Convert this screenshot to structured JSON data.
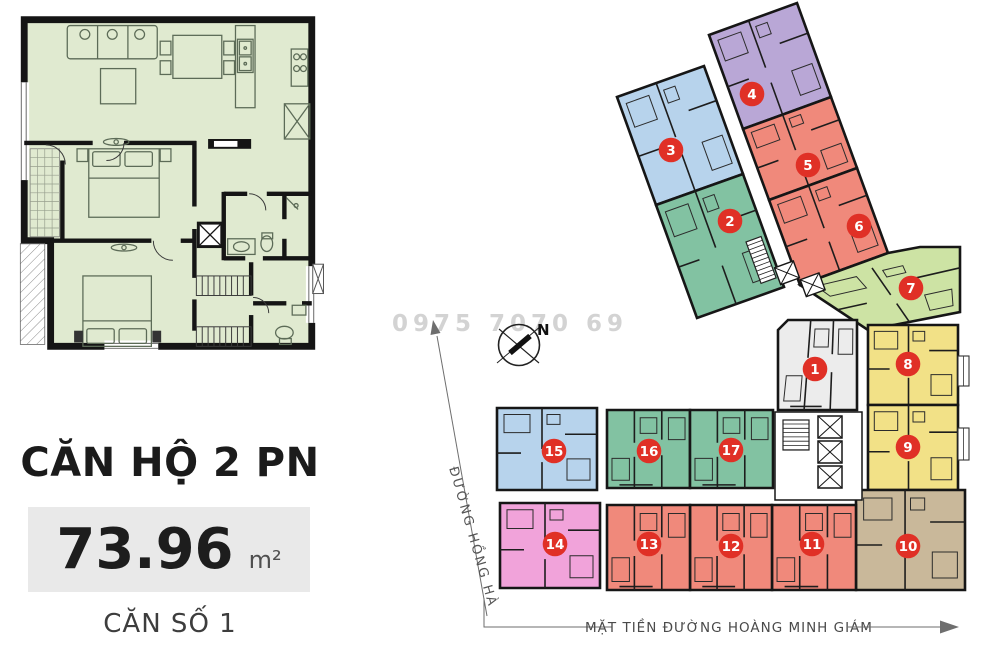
{
  "left_panel": {
    "unit_type_label": "CĂN HỘ 2 PN",
    "area_value": "73.96",
    "area_unit": "m²",
    "unit_number_label": "CĂN SỐ 1"
  },
  "site_plan": {
    "watermark": "0975 7070 69",
    "compass_label": "N",
    "street_left_label": "ĐƯỜNG HỒNG HÀ",
    "street_bottom_label": "MẶT TIỀN ĐƯỜNG HOÀNG MINH GIÁM",
    "colors": {
      "badge": "#e03026",
      "wall": "#161616",
      "inner_wall": "#1d1d1d",
      "arrow_gray": "#6e6e6e"
    },
    "units": [
      {
        "n": "3",
        "color": "#b7d3ec",
        "tpl": "A",
        "badge": [
          671,
          150
        ],
        "poly": [
          [
            617,
            97
          ],
          [
            704,
            66
          ],
          [
            743,
            174
          ],
          [
            656,
            205
          ]
        ]
      },
      {
        "n": "4",
        "color": "#b9a7d6",
        "tpl": "A",
        "badge": [
          752,
          94
        ],
        "poly": [
          [
            709,
            35
          ],
          [
            797,
            3
          ],
          [
            831,
            97
          ],
          [
            743,
            129
          ]
        ]
      },
      {
        "n": "2",
        "color": "#82c2a2",
        "tpl": "A",
        "badge": [
          730,
          221
        ],
        "poly": [
          [
            656,
            205
          ],
          [
            743,
            174
          ],
          [
            784,
            287
          ],
          [
            697,
            318
          ]
        ]
      },
      {
        "n": "5",
        "color": "#f0897b",
        "tpl": "A",
        "badge": [
          808,
          165
        ],
        "poly": [
          [
            743,
            129
          ],
          [
            831,
            97
          ],
          [
            857,
            168
          ],
          [
            769,
            200
          ]
        ]
      },
      {
        "n": "6",
        "color": "#f0897b",
        "tpl": "A",
        "badge": [
          859,
          226
        ],
        "poly": [
          [
            769,
            200
          ],
          [
            857,
            168
          ],
          [
            888,
            253
          ],
          [
            800,
            285
          ]
        ]
      },
      {
        "n": "7",
        "color": "#cde3a4",
        "tpl": "A",
        "badge": [
          911,
          288
        ],
        "poly": [
          [
            800,
            285
          ],
          [
            888,
            253
          ],
          [
            920,
            247
          ],
          [
            960,
            247
          ],
          [
            960,
            312
          ],
          [
            868,
            330
          ]
        ],
        "quad": [
          [
            800,
            285
          ],
          [
            960,
            247
          ],
          [
            960,
            312
          ],
          [
            868,
            330
          ]
        ]
      },
      {
        "n": "8",
        "color": "#f2e187",
        "tpl": "A",
        "badge": [
          908,
          364
        ],
        "poly": [
          [
            868,
            325
          ],
          [
            958,
            325
          ],
          [
            958,
            405
          ],
          [
            868,
            405
          ]
        ]
      },
      {
        "n": "9",
        "color": "#f2e187",
        "tpl": "A",
        "badge": [
          908,
          447
        ],
        "poly": [
          [
            868,
            405
          ],
          [
            958,
            405
          ],
          [
            958,
            490
          ],
          [
            868,
            490
          ]
        ]
      },
      {
        "n": "10",
        "color": "#c9b89a",
        "tpl": "A",
        "badge": [
          908,
          546
        ],
        "poly": [
          [
            856,
            490
          ],
          [
            965,
            490
          ],
          [
            965,
            590
          ],
          [
            856,
            590
          ]
        ]
      },
      {
        "n": "11",
        "color": "#f0897b",
        "tpl": "B",
        "badge": [
          812,
          544
        ],
        "poly": [
          [
            772,
            505
          ],
          [
            856,
            505
          ],
          [
            856,
            590
          ],
          [
            772,
            590
          ]
        ]
      },
      {
        "n": "12",
        "color": "#f0897b",
        "tpl": "B",
        "badge": [
          731,
          546
        ],
        "poly": [
          [
            690,
            505
          ],
          [
            772,
            505
          ],
          [
            772,
            590
          ],
          [
            690,
            590
          ]
        ]
      },
      {
        "n": "13",
        "color": "#f0897b",
        "tpl": "B",
        "badge": [
          649,
          544
        ],
        "poly": [
          [
            607,
            505
          ],
          [
            690,
            505
          ],
          [
            690,
            590
          ],
          [
            607,
            590
          ]
        ]
      },
      {
        "n": "14",
        "color": "#f1a3da",
        "tpl": "A",
        "badge": [
          555,
          544
        ],
        "poly": [
          [
            500,
            503
          ],
          [
            600,
            503
          ],
          [
            600,
            588
          ],
          [
            500,
            588
          ]
        ]
      },
      {
        "n": "15",
        "color": "#b7d3ec",
        "tpl": "A",
        "badge": [
          554,
          451
        ],
        "poly": [
          [
            497,
            408
          ],
          [
            597,
            408
          ],
          [
            597,
            490
          ],
          [
            497,
            490
          ]
        ]
      },
      {
        "n": "16",
        "color": "#82c2a2",
        "tpl": "B",
        "badge": [
          649,
          451
        ],
        "poly": [
          [
            607,
            410
          ],
          [
            690,
            410
          ],
          [
            690,
            488
          ],
          [
            607,
            488
          ]
        ]
      },
      {
        "n": "17",
        "color": "#82c2a2",
        "tpl": "B",
        "badge": [
          731,
          450
        ],
        "poly": [
          [
            690,
            410
          ],
          [
            773,
            410
          ],
          [
            773,
            488
          ],
          [
            690,
            488
          ]
        ]
      },
      {
        "n": "1",
        "color": "#ececec",
        "tpl": "B",
        "badge": [
          815,
          369
        ],
        "poly": [
          [
            788,
            320
          ],
          [
            857,
            320
          ],
          [
            857,
            410
          ],
          [
            778,
            410
          ],
          [
            778,
            330
          ]
        ],
        "quad": [
          [
            788,
            320
          ],
          [
            857,
            320
          ],
          [
            857,
            410
          ],
          [
            778,
            410
          ]
        ]
      }
    ]
  }
}
